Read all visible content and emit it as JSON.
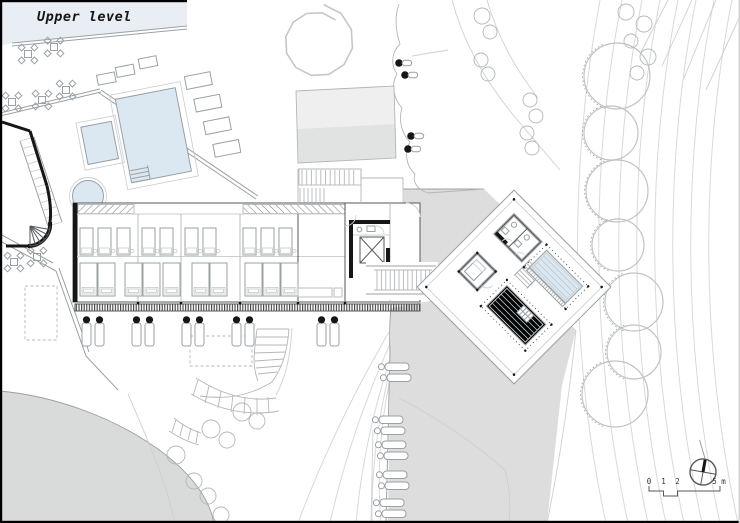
{
  "title": "Upper level",
  "scale_bar": {
    "labels": [
      "0",
      "1",
      "2",
      "5 m"
    ]
  },
  "icons": {
    "north_arrow": "circle-cross-north-arrow"
  },
  "colors": {
    "paper": "#ffffff",
    "pool": "#dce8f1",
    "terrace_tint": "#e9eef4",
    "slope": "#dcdddc",
    "mound": "#d9dada",
    "roof_light": "#efefef",
    "roof_dark": "#e1e2e2",
    "ink": "#161616",
    "line_dark": "#55585a",
    "line_mid": "#9aa0a3",
    "line_light": "#cdd0d2",
    "contour": "#d7d9da"
  }
}
